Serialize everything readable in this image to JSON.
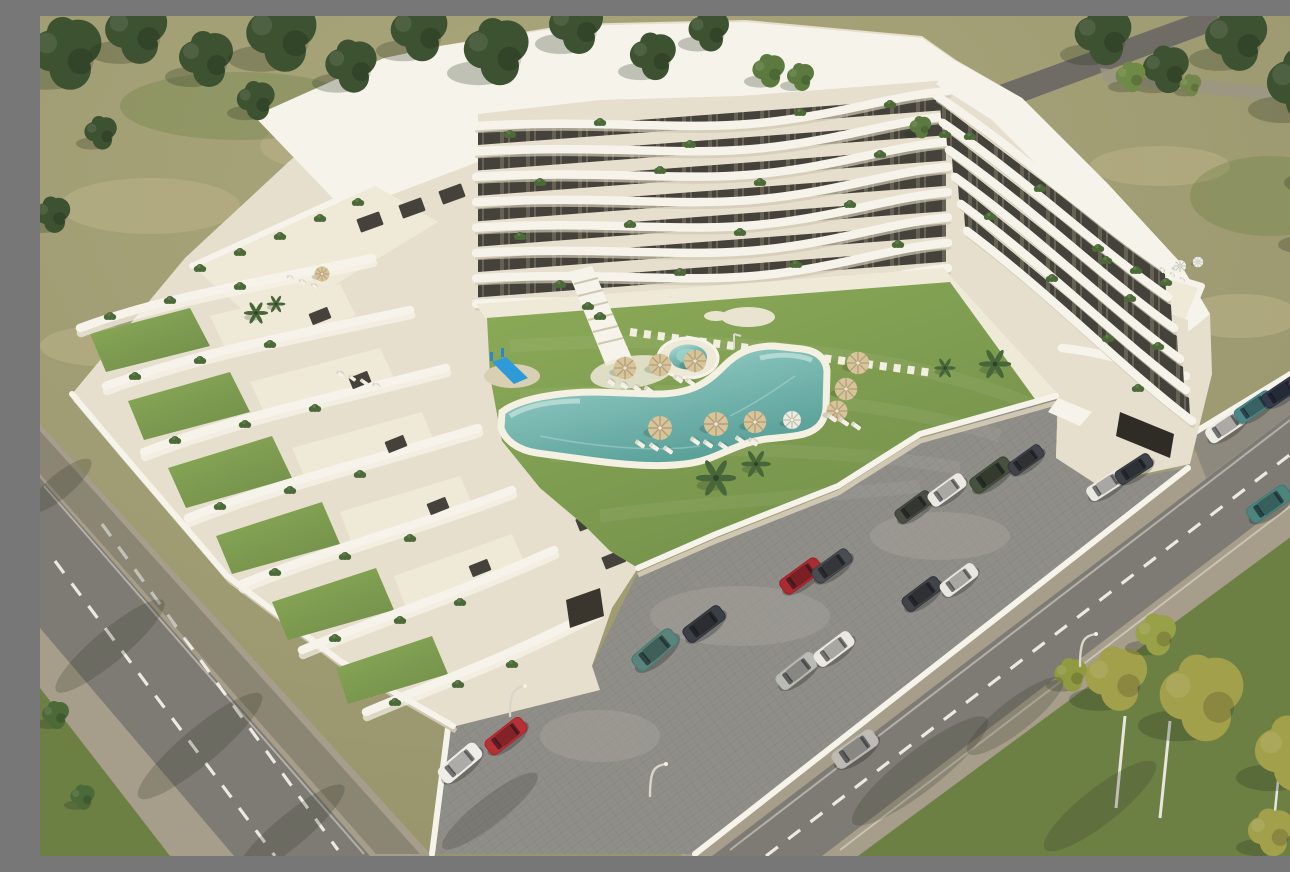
{
  "meta": {
    "alt": "Aerial 3D architectural rendering of a white terraced apartment complex with stepped balconies, private roof gardens, a central courtyard with lawn, curved swimming pool, round spa, sun umbrellas and loungers, a children's slide, a cobbled parking lot with cars, tree-lined streets and olive-green fields."
  },
  "palette": {
    "field": "#a19d72",
    "fieldLight": "#bcb288",
    "grassDark": "#6d8044",
    "lawn": "#7e9c50",
    "lawnLight": "#8fab5c",
    "treeDark": "#3d5230",
    "treeYellow": "#a3a04c",
    "road": "#7e7b74",
    "sidewalk": "#a69d8a",
    "parking": "#908e89",
    "white": "#f6f3ea",
    "cream": "#e6dfcd",
    "facade": "#d9d2bf",
    "windowDark": "#44423a",
    "poolWater": "#7fbdb6",
    "poolLight": "#b9e2d8",
    "poolDeep": "#569e96",
    "deck": "#efe9d8",
    "umbrella": "#d8c49a",
    "wallShadow": "#cfc7b2",
    "shadow": "#2e3226"
  },
  "scene": {
    "building": {
      "top_wing_floors": 8,
      "right_wing_floors": 6
    },
    "collections": [
      {
        "layer": "trees-dark",
        "symbol": "s-tree",
        "name": "tree-dark",
        "default": {
          "s": 1,
          "rot": 0,
          "c": "#3d5230"
        },
        "items": [
          [
            25,
            40,
            2.6
          ],
          [
            95,
            18,
            2.3
          ],
          [
            165,
            45,
            2.0
          ],
          [
            240,
            22,
            2.6
          ],
          [
            310,
            52,
            1.9
          ],
          [
            378,
            18,
            2.1
          ],
          [
            455,
            38,
            2.4
          ],
          [
            535,
            12,
            2.0
          ],
          [
            612,
            42,
            1.7
          ],
          [
            668,
            16,
            1.5
          ],
          [
            728,
            56,
            1.2,
            0,
            "#5c7a40"
          ],
          [
            60,
            118,
            1.2
          ],
          [
            215,
            86,
            1.4
          ],
          [
            12,
            200,
            1.3
          ],
          [
            760,
            62,
            1.0,
            0,
            "#5c7a40"
          ],
          [
            880,
            112,
            0.8,
            0,
            "#5c7a40"
          ],
          [
            1062,
            22,
            2.1
          ],
          [
            1125,
            55,
            1.7
          ],
          [
            1195,
            25,
            2.3
          ],
          [
            1262,
            72,
            2.7
          ],
          [
            1286,
            150,
            2.1
          ],
          [
            1272,
            215,
            1.7
          ],
          [
            1090,
            62,
            1.1,
            0,
            "#6e8a46"
          ],
          [
            1150,
            70,
            0.8,
            0,
            "#72864a"
          ],
          [
            15,
            700,
            1.0,
            0,
            "#4c6a38"
          ],
          [
            42,
            782,
            0.9,
            0,
            "#4c6a38"
          ]
        ]
      },
      {
        "layer": "trees-yellow",
        "symbol": "s-tree",
        "name": "tree-yellow",
        "default": {
          "s": 1,
          "rot": 0,
          "c": "#a3a04c"
        },
        "items": [
          [
            1075,
            665,
            2.3
          ],
          [
            1160,
            685,
            3.1
          ],
          [
            1250,
            740,
            2.7
          ],
          [
            1288,
            652,
            1.9
          ],
          [
            1230,
            818,
            1.7
          ],
          [
            1030,
            660,
            1.2,
            0,
            "#8f9a42"
          ],
          [
            1115,
            620,
            1.5,
            0,
            "#98a048"
          ]
        ]
      },
      {
        "layer": "palms",
        "symbol": "s-palm",
        "name": "palm-tree",
        "default": {
          "s": 1,
          "rot": 0,
          "c": "#47663a"
        },
        "items": [
          [
            676,
            462,
            1.5
          ],
          [
            716,
            448,
            1.1
          ],
          [
            955,
            348,
            1.2
          ],
          [
            216,
            297,
            0.9
          ],
          [
            236,
            288,
            0.7
          ],
          [
            905,
            352,
            0.8
          ]
        ]
      },
      {
        "layer": "bushes",
        "symbol": "s-bush",
        "name": "planter-bush",
        "default": {
          "s": 1,
          "rot": 0,
          "c": "#4c6a38"
        },
        "items": [
          [
            470,
            118
          ],
          [
            560,
            106
          ],
          [
            650,
            128
          ],
          [
            760,
            96
          ],
          [
            850,
            88
          ],
          [
            905,
            118
          ],
          [
            500,
            166
          ],
          [
            620,
            154
          ],
          [
            720,
            166
          ],
          [
            840,
            138
          ],
          [
            480,
            220
          ],
          [
            590,
            208
          ],
          [
            700,
            216
          ],
          [
            810,
            188
          ],
          [
            520,
            268
          ],
          [
            640,
            256
          ],
          [
            756,
            248
          ],
          [
            858,
            228
          ],
          [
            930,
            120
          ],
          [
            1000,
            172
          ],
          [
            1058,
            232
          ],
          [
            1090,
            282
          ],
          [
            1118,
            330
          ],
          [
            950,
            200
          ],
          [
            1012,
            262
          ],
          [
            1068,
            322
          ],
          [
            1098,
            372
          ],
          [
            70,
            300
          ],
          [
            130,
            284
          ],
          [
            200,
            270
          ],
          [
            95,
            360
          ],
          [
            160,
            344
          ],
          [
            230,
            328
          ],
          [
            135,
            424
          ],
          [
            205,
            408
          ],
          [
            275,
            392
          ],
          [
            180,
            490
          ],
          [
            250,
            474
          ],
          [
            320,
            458
          ],
          [
            235,
            556
          ],
          [
            305,
            540
          ],
          [
            370,
            522
          ],
          [
            295,
            622
          ],
          [
            360,
            604
          ],
          [
            420,
            586
          ],
          [
            355,
            686
          ],
          [
            418,
            668
          ],
          [
            472,
            648
          ],
          [
            160,
            252
          ],
          [
            200,
            236
          ],
          [
            240,
            220
          ],
          [
            280,
            202
          ],
          [
            318,
            186
          ],
          [
            1066,
            244
          ],
          [
            1096,
            254
          ],
          [
            1126,
            266
          ],
          [
            560,
            300
          ],
          [
            548,
            290
          ]
        ]
      },
      {
        "layer": "umbrellas",
        "symbol": "s-umb",
        "name": "sun-umbrella",
        "default": {
          "s": 1.5,
          "rot": 0,
          "c": "#d8c49a"
        },
        "items": [
          [
            585,
            352
          ],
          [
            620,
            349
          ],
          [
            655,
            345
          ],
          [
            620,
            412,
            1.6
          ],
          [
            676,
            408,
            1.6
          ],
          [
            715,
            406,
            1.5
          ],
          [
            752,
            404,
            1.2,
            0,
            "#ecebe0"
          ],
          [
            818,
            347
          ],
          [
            806,
            373
          ],
          [
            797,
            395,
            1.4
          ],
          [
            282,
            258,
            1.0
          ],
          [
            1140,
            250,
            0.8,
            0,
            "#eef0ea"
          ],
          [
            1158,
            246,
            0.7,
            0,
            "#eef0ea"
          ]
        ]
      },
      {
        "layer": "loungers",
        "symbol": "s-lounger",
        "name": "sun-lounger",
        "default": {
          "s": 1,
          "rot": -55,
          "c": "#f3f0e5"
        },
        "items": [
          [
            570,
            366
          ],
          [
            583,
            369
          ],
          [
            596,
            372
          ],
          [
            609,
            374
          ],
          [
            638,
            363
          ],
          [
            650,
            366
          ],
          [
            600,
            428
          ],
          [
            614,
            431
          ],
          [
            628,
            434
          ],
          [
            655,
            425
          ],
          [
            668,
            428
          ],
          [
            683,
            430
          ],
          [
            700,
            424
          ],
          [
            713,
            426
          ],
          [
            792,
            402
          ],
          [
            804,
            406
          ],
          [
            816,
            410
          ],
          [
            300,
            358,
            0.8
          ],
          [
            312,
            362,
            0.8
          ],
          [
            324,
            366,
            0.8
          ],
          [
            336,
            370,
            0.8
          ],
          [
            250,
            262,
            0.7
          ],
          [
            262,
            266,
            0.7
          ],
          [
            274,
            270,
            0.7
          ],
          [
            1122,
            254,
            0.6,
            -30
          ],
          [
            1132,
            259,
            0.6,
            -30
          ],
          [
            1142,
            264,
            0.6,
            -30
          ]
        ]
      },
      {
        "layer": "cars",
        "symbol": "s-car",
        "name": "car",
        "default": {
          "s": 1,
          "rot": -37,
          "c": "#888888"
        },
        "items": [
          [
            615,
            634,
            1.12,
            -40,
            "#4a7a70"
          ],
          [
            664,
            608,
            1,
            -37,
            "#2c2f36"
          ],
          [
            761,
            560,
            1,
            -36,
            "#a31b22"
          ],
          [
            792,
            550,
            0.95,
            -36,
            "#3a3d42"
          ],
          [
            757,
            655,
            1,
            -38,
            "#b6b6b0"
          ],
          [
            794,
            633,
            0.95,
            -37,
            "#e9e7df"
          ],
          [
            466,
            720,
            1,
            -38,
            "#b02025"
          ],
          [
            420,
            747,
            1.05,
            -40,
            "#eeece6"
          ],
          [
            882,
            578,
            0.95,
            -37,
            "#303339"
          ],
          [
            919,
            564,
            0.9,
            -37,
            "#e7e5de"
          ],
          [
            874,
            491,
            0.9,
            -36,
            "#3a3e35"
          ],
          [
            907,
            474,
            0.9,
            -36,
            "#eae8e0"
          ],
          [
            951,
            459,
            1,
            -36,
            "#39432f"
          ],
          [
            986,
            444,
            0.85,
            -36,
            "#30333a"
          ],
          [
            1066,
            469,
            0.9,
            -33,
            "#e9e7e0"
          ],
          [
            1094,
            453,
            0.88,
            -33,
            "#2f3339"
          ],
          [
            1186,
            410,
            0.95,
            -34,
            "#edebe3"
          ],
          [
            1214,
            391,
            0.92,
            -34,
            "#3f7d80"
          ],
          [
            1241,
            376,
            0.9,
            -34,
            "#232b3e"
          ],
          [
            1267,
            362,
            0.85,
            -34,
            "#4a2a30"
          ],
          [
            815,
            733,
            1.08,
            -35,
            "#b9b6ae"
          ],
          [
            1229,
            488,
            1.05,
            -35,
            "#3e7a74"
          ]
        ]
      }
    ]
  }
}
